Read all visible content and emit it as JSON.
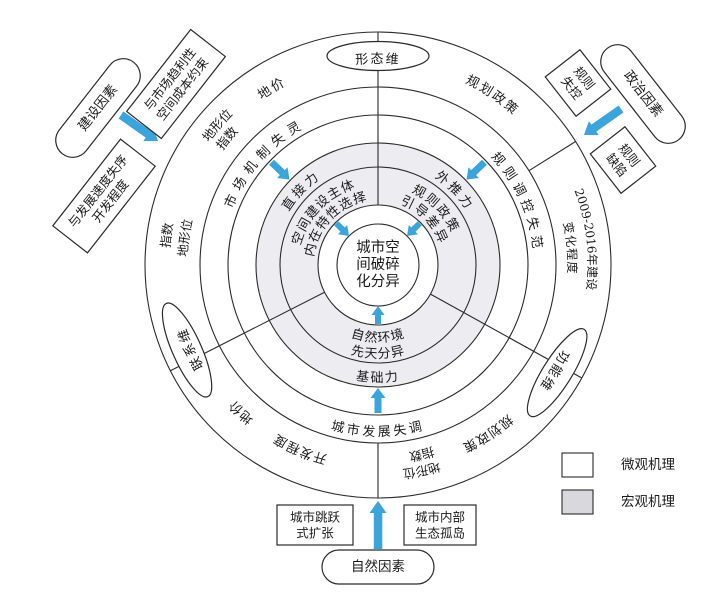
{
  "figure_name": "urban-spatial-fragmentation-mechanism-diagram",
  "colors": {
    "arrow_blue": "#3BA4DA",
    "line": "#2B2B2B",
    "macro_ring_fill": "#EDEDF1",
    "micro_ring_fill": "#FFFFFF",
    "legend_gray": "#D9D9DD"
  },
  "canvas": {
    "w": 720,
    "h": 594,
    "cx": 378,
    "cy": 265
  },
  "circles": [
    {
      "name": "outer-circle",
      "r": 233,
      "fill": "#FFFFFF"
    },
    {
      "name": "ring4-inner-circle",
      "r": 178,
      "fill": "#FFFFFF"
    },
    {
      "name": "ring3-inner-circle",
      "r": 150,
      "fill": "#FFFFFF"
    },
    {
      "name": "ring2-outer-circle",
      "r": 122,
      "fill": "#EDEDF1"
    },
    {
      "name": "ring1-outer-circle",
      "r": 98,
      "fill": "#EDEDF1"
    },
    {
      "name": "inner-buffer-circle",
      "r": 60,
      "fill": "#FFFFFF"
    },
    {
      "name": "core-circle",
      "r": 41,
      "fill": "#FFFFFF"
    }
  ],
  "dividers": [
    {
      "angle": 90,
      "r1": 60,
      "r2": 233
    },
    {
      "angle": 207,
      "r1": 60,
      "r2": 233
    },
    {
      "angle": 331,
      "r1": 60,
      "r2": 233
    },
    {
      "angle": 270,
      "r1": 178,
      "r2": 233
    },
    {
      "angle": 32,
      "r1": 178,
      "r2": 233
    }
  ],
  "core": {
    "lines": [
      "城市空",
      "间破碎",
      "化分异"
    ]
  },
  "curved_labels": [
    {
      "text": "空间建设主体",
      "angle": 136,
      "radius": 80,
      "dir": "cw",
      "fs": 13,
      "ls": 1
    },
    {
      "text": "内在特性选择",
      "angle": 136,
      "radius": 65,
      "dir": "cw",
      "fs": 13,
      "ls": 1
    },
    {
      "text": "直接力",
      "angle": 136,
      "radius": 104,
      "dir": "cw",
      "fs": 13,
      "ls": 3
    },
    {
      "text": "市场机制失灵",
      "angle": 138,
      "radius": 156,
      "dir": "cw",
      "fs": 13,
      "ls": 6
    },
    {
      "text": "规则政策",
      "angle": 44,
      "radius": 80,
      "dir": "cw",
      "fs": 13,
      "ls": 2
    },
    {
      "text": "引导差异",
      "angle": 44,
      "radius": 65,
      "dir": "cw",
      "fs": 13,
      "ls": 2
    },
    {
      "text": "外推力",
      "angle": 44,
      "radius": 104,
      "dir": "cw",
      "fs": 13,
      "ls": 3
    },
    {
      "text": "规则调控失范",
      "angle": 24,
      "radius": 156,
      "dir": "cw",
      "fs": 13,
      "ls": 5
    },
    {
      "text": "自然环境",
      "angle": 270,
      "radius": 77,
      "dir": "ccw",
      "fs": 13,
      "ls": 1
    },
    {
      "text": "先天分异",
      "angle": 270,
      "radius": 93,
      "dir": "ccw",
      "fs": 13,
      "ls": 1
    },
    {
      "text": "基础力",
      "angle": 270,
      "radius": 117,
      "dir": "ccw",
      "fs": 13,
      "ls": 2
    },
    {
      "text": "城市发展失调",
      "angle": 270,
      "radius": 171,
      "dir": "ccw",
      "fs": 13,
      "ls": 3
    },
    {
      "text": "地价",
      "angle": 121,
      "radius": 202,
      "dir": "cw",
      "fs": 13,
      "ls": 2
    },
    {
      "text": "地形位",
      "angle": 139,
      "radius": 209,
      "dir": "cw",
      "fs": 12.5,
      "ls": 0
    },
    {
      "text": "指数",
      "angle": 140,
      "radius": 193,
      "dir": "cw",
      "fs": 12.5,
      "ls": 0
    },
    {
      "text": "指数",
      "angle": 172,
      "radius": 209,
      "dir": "cw",
      "fs": 12.5,
      "ls": 0
    },
    {
      "text": "地形位",
      "angle": 172,
      "radius": 191,
      "dir": "cw",
      "fs": 12.5,
      "ls": 0
    },
    {
      "text": "规划政策",
      "angle": 56,
      "radius": 202,
      "dir": "cw",
      "fs": 13,
      "ls": 2
    },
    {
      "text": "2009-2016年建设",
      "angle": 7,
      "radius": 210,
      "dir": "cw",
      "fs": 12,
      "ls": 0
    },
    {
      "text": "变化程度",
      "angle": 5,
      "radius": 190,
      "dir": "cw",
      "fs": 12,
      "ls": 1
    },
    {
      "text": "规划政策",
      "angle": 303,
      "radius": 198,
      "dir": "cw",
      "fs": 13,
      "ls": 1
    },
    {
      "text": "地形位",
      "angle": 282,
      "radius": 206,
      "dir": "cw",
      "fs": 12.5,
      "ls": 0
    },
    {
      "text": "指数",
      "angle": 283,
      "radius": 190,
      "dir": "cw",
      "fs": 12.5,
      "ls": 0
    },
    {
      "text": "开发程度",
      "angle": 247,
      "radius": 197,
      "dir": "cw",
      "fs": 13,
      "ls": 1
    },
    {
      "text": "地价",
      "angle": 227,
      "radius": 197,
      "dir": "cw",
      "fs": 13,
      "ls": 1
    }
  ],
  "dimension_badges": [
    {
      "text": "形态维",
      "angle": 90,
      "ellipse_rot": 0
    },
    {
      "text": "联系维",
      "angle": 204,
      "ellipse_rot": 66
    },
    {
      "text": "功能维",
      "angle": 329,
      "ellipse_rot": -58
    }
  ],
  "badge_geometry": {
    "center_r": 209,
    "rx": 51,
    "ry": 14.5,
    "text_r": 202,
    "fs": 13,
    "ls": 2
  },
  "arrows": [
    {
      "type": "polar",
      "angle": 135,
      "r1": 59,
      "r2": 41,
      "size": "s"
    },
    {
      "type": "polar",
      "angle": 45,
      "r1": 59,
      "r2": 41,
      "size": "s"
    },
    {
      "type": "polar",
      "angle": 270,
      "r1": 59,
      "r2": 41,
      "size": "s"
    },
    {
      "type": "polar",
      "angle": 136,
      "r1": 148,
      "r2": 123,
      "size": "m"
    },
    {
      "type": "polar",
      "angle": 44,
      "r1": 148,
      "r2": 123,
      "size": "m"
    },
    {
      "type": "polar",
      "angle": 270,
      "r1": 148,
      "r2": 123,
      "size": "m"
    },
    {
      "type": "xy",
      "x1": 121,
      "y1": 115,
      "x2": 158,
      "y2": 141,
      "size": "l"
    },
    {
      "type": "xy",
      "x1": 621,
      "y1": 109,
      "x2": 584,
      "y2": 135,
      "size": "l"
    },
    {
      "type": "xy",
      "x1": 378,
      "y1": 549,
      "x2": 378,
      "y2": 501,
      "size": "l"
    }
  ],
  "external_nodes": [
    {
      "name": "construction-factors",
      "shape": "stadium",
      "lines": [
        "建设因素"
      ],
      "cx": 98,
      "cy": 108,
      "w": 116,
      "h": 34,
      "rot": -52,
      "fs": 13.5,
      "reverse": false
    },
    {
      "name": "spatial-cost-constraint",
      "shape": "rect",
      "lines": [
        "空间成本约束",
        "与市场趋利性"
      ],
      "cx": 176,
      "cy": 84,
      "w": 104,
      "h": 44,
      "rot": -52,
      "fs": 12.5,
      "reverse": true
    },
    {
      "name": "development-speed-disorder",
      "shape": "rect",
      "lines": [
        "开发程度",
        "与发展速度失序"
      ],
      "cx": 104,
      "cy": 196,
      "w": 110,
      "h": 44,
      "rot": -52,
      "fs": 12.5,
      "reverse": true
    },
    {
      "name": "political-factors",
      "shape": "stadium",
      "lines": [
        "政治因素"
      ],
      "cx": 643,
      "cy": 94,
      "w": 116,
      "h": 34,
      "rot": 52,
      "fs": 13.5,
      "reverse": false
    },
    {
      "name": "rules-out-of-control",
      "shape": "rect",
      "lines": [
        "规则",
        "失控"
      ],
      "cx": 578,
      "cy": 83,
      "w": 50,
      "h": 44,
      "rot": 52,
      "fs": 12.5,
      "reverse": false
    },
    {
      "name": "rule-defects",
      "shape": "rect",
      "lines": [
        "规则",
        "缺陷"
      ],
      "cx": 623,
      "cy": 160,
      "w": 50,
      "h": 44,
      "rot": 52,
      "fs": 12.5,
      "reverse": false
    },
    {
      "name": "urban-leapfrog-expansion",
      "shape": "rect",
      "lines": [
        "城市跳跃",
        "式扩张"
      ],
      "cx": 315,
      "cy": 525,
      "w": 76,
      "h": 40,
      "rot": 0,
      "fs": 12.5,
      "reverse": false
    },
    {
      "name": "urban-inner-eco-islands",
      "shape": "rect",
      "lines": [
        "城市内部",
        "生态孤岛"
      ],
      "cx": 440,
      "cy": 525,
      "w": 72,
      "h": 40,
      "rot": 0,
      "fs": 12.5,
      "reverse": false
    },
    {
      "name": "natural-factors",
      "shape": "stadium",
      "lines": [
        "自然因素"
      ],
      "cx": 378,
      "cy": 567,
      "w": 112,
      "h": 34,
      "rot": 0,
      "fs": 13.5,
      "reverse": false
    }
  ],
  "legend": {
    "x": 562,
    "y": 453,
    "row_gap": 37,
    "swatch_w": 31,
    "swatch_h": 24,
    "items": [
      {
        "label": "微观机理",
        "fill": "#FFFFFF"
      },
      {
        "label": "宏观机理",
        "fill": "#D9D9DD"
      }
    ]
  }
}
